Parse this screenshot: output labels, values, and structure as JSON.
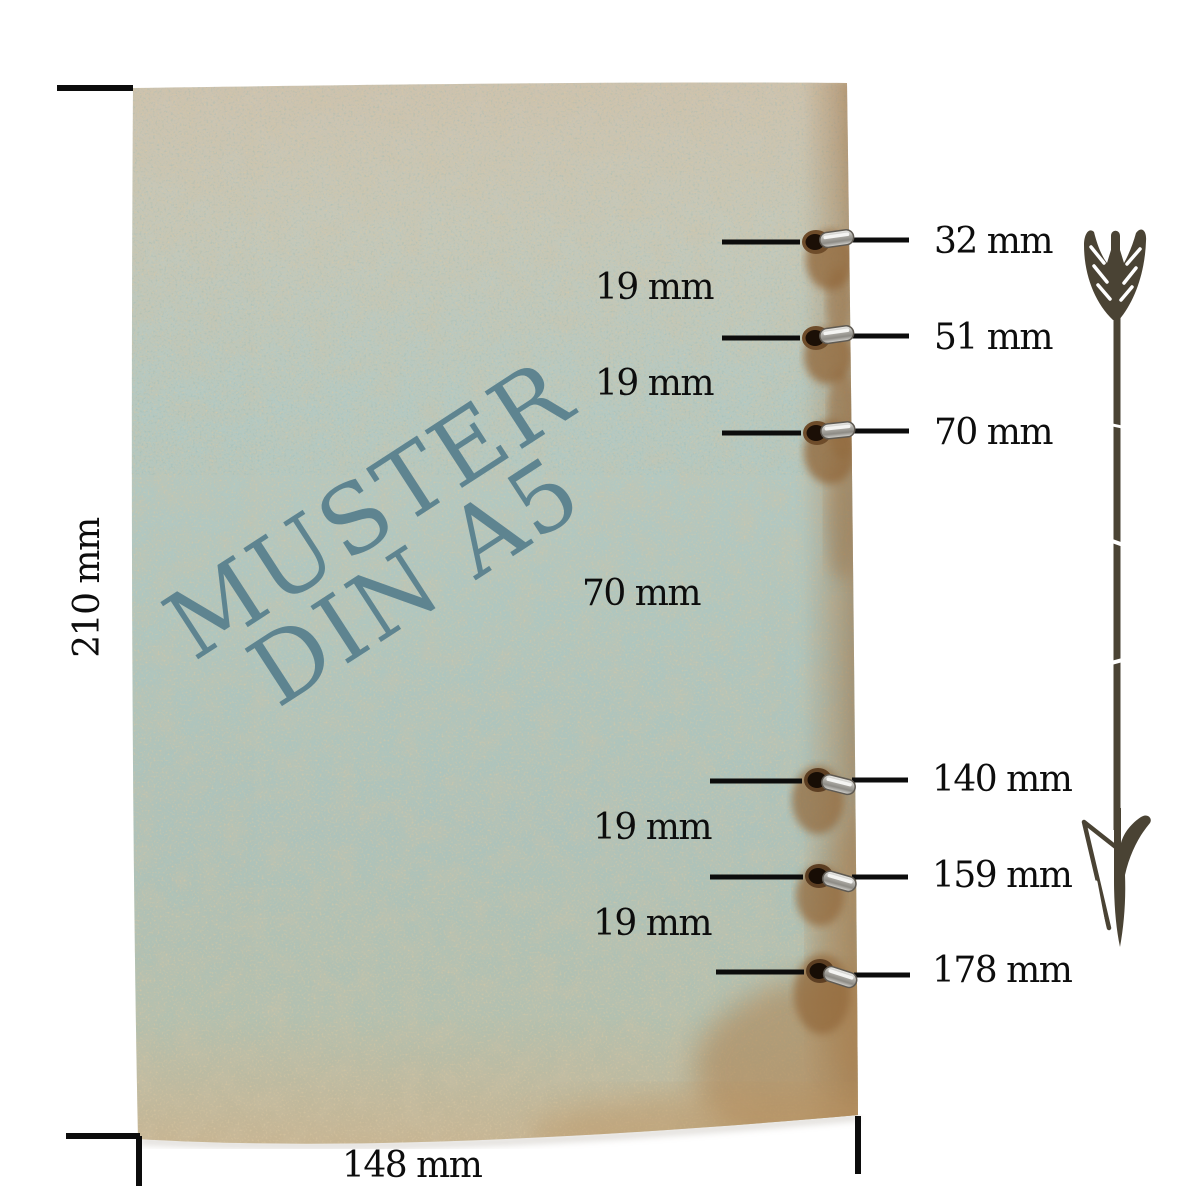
{
  "page": {
    "background_color": "#ffffff"
  },
  "paper": {
    "watermark": {
      "line1": "MUSTER",
      "line2": "DIN A5",
      "color": "#577f8d"
    },
    "height_label": "210 mm",
    "width_label": "148 mm",
    "height_mm": 210,
    "width_mm": 148,
    "top_color": "#cdc3b0",
    "middle_color": "#afc6bf",
    "edge_stain_color": "#a5794a"
  },
  "holes": [
    {
      "label": "32 mm",
      "distance_mm": 32
    },
    {
      "label": "51 mm",
      "distance_mm": 51
    },
    {
      "label": "70 mm",
      "distance_mm": 70
    },
    {
      "label": "140 mm",
      "distance_mm": 140
    },
    {
      "label": "159 mm",
      "distance_mm": 159
    },
    {
      "label": "178 mm",
      "distance_mm": 178
    }
  ],
  "gaps": [
    {
      "label": "19 mm",
      "value_mm": 19
    },
    {
      "label": "19 mm",
      "value_mm": 19
    },
    {
      "label": "70 mm",
      "value_mm": 70
    },
    {
      "label": "19 mm",
      "value_mm": 19
    },
    {
      "label": "19 mm",
      "value_mm": 19
    }
  ],
  "arrow": {
    "color": "#4a4334",
    "direction": "down"
  },
  "line_color": "#0c0c0c"
}
